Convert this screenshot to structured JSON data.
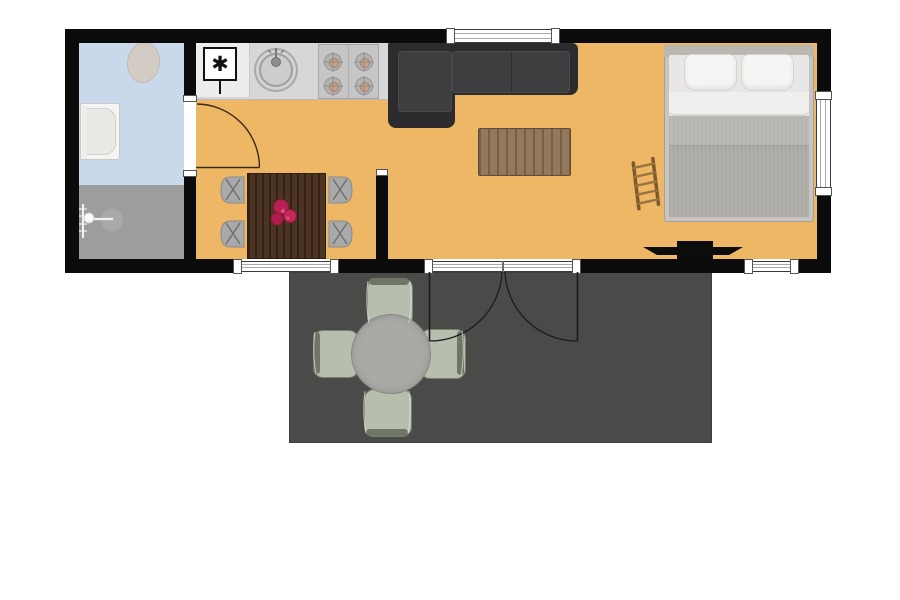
{
  "scene": {
    "type": "tiny-house-floor-plan",
    "rooms": [
      "bathroom",
      "kitchen",
      "dining-area",
      "living-area",
      "bedroom",
      "deck"
    ]
  },
  "symbols": {
    "utility_marker": "✱"
  },
  "colors": {
    "bg": "#ffffff",
    "wall": "#0b0b0b",
    "floor": "#edb766",
    "bath_blue": "#c9d9eb",
    "bath_gray": "#9d9d9d",
    "counter": "#d7d7d7",
    "counter_white": "#ededed",
    "stove": "#c6c6c6",
    "burner": "#b3b3b3",
    "burner_center": "#c9a083",
    "sink_outer": "#d3d3d3",
    "sink_inner": "#cdcdcd",
    "sofa_shell": "#2c2c2e",
    "sofa_cushion": "#3e3e40",
    "coffee_table": "#8d7154",
    "dining_table": "#452c1b",
    "flower": "#b82253",
    "chair": "#a9a9a9",
    "bed_frame": "#c8c5c0",
    "headboard": "#bab7b1",
    "mattress": "#e8e7e5",
    "pillow": "#f5f5f4",
    "sheet": "#efefee",
    "blanket": "#bbb9b6",
    "blanket_dark": "#b0aeab",
    "ladder": "#7d5a2e",
    "ladder_rung": "#9b7340",
    "tv": "#0d0d0d",
    "deck": "#4a4a48",
    "deck_chair": "#b7beae",
    "deck_chair_back": "#6f7668",
    "deck_table": "#a9a9a5",
    "window": "#ffffff",
    "toilet": "#d2ccc4",
    "tub": "#f4f4f2",
    "door_arc": "#3a2a12",
    "door_line": "#1c1c1c"
  }
}
